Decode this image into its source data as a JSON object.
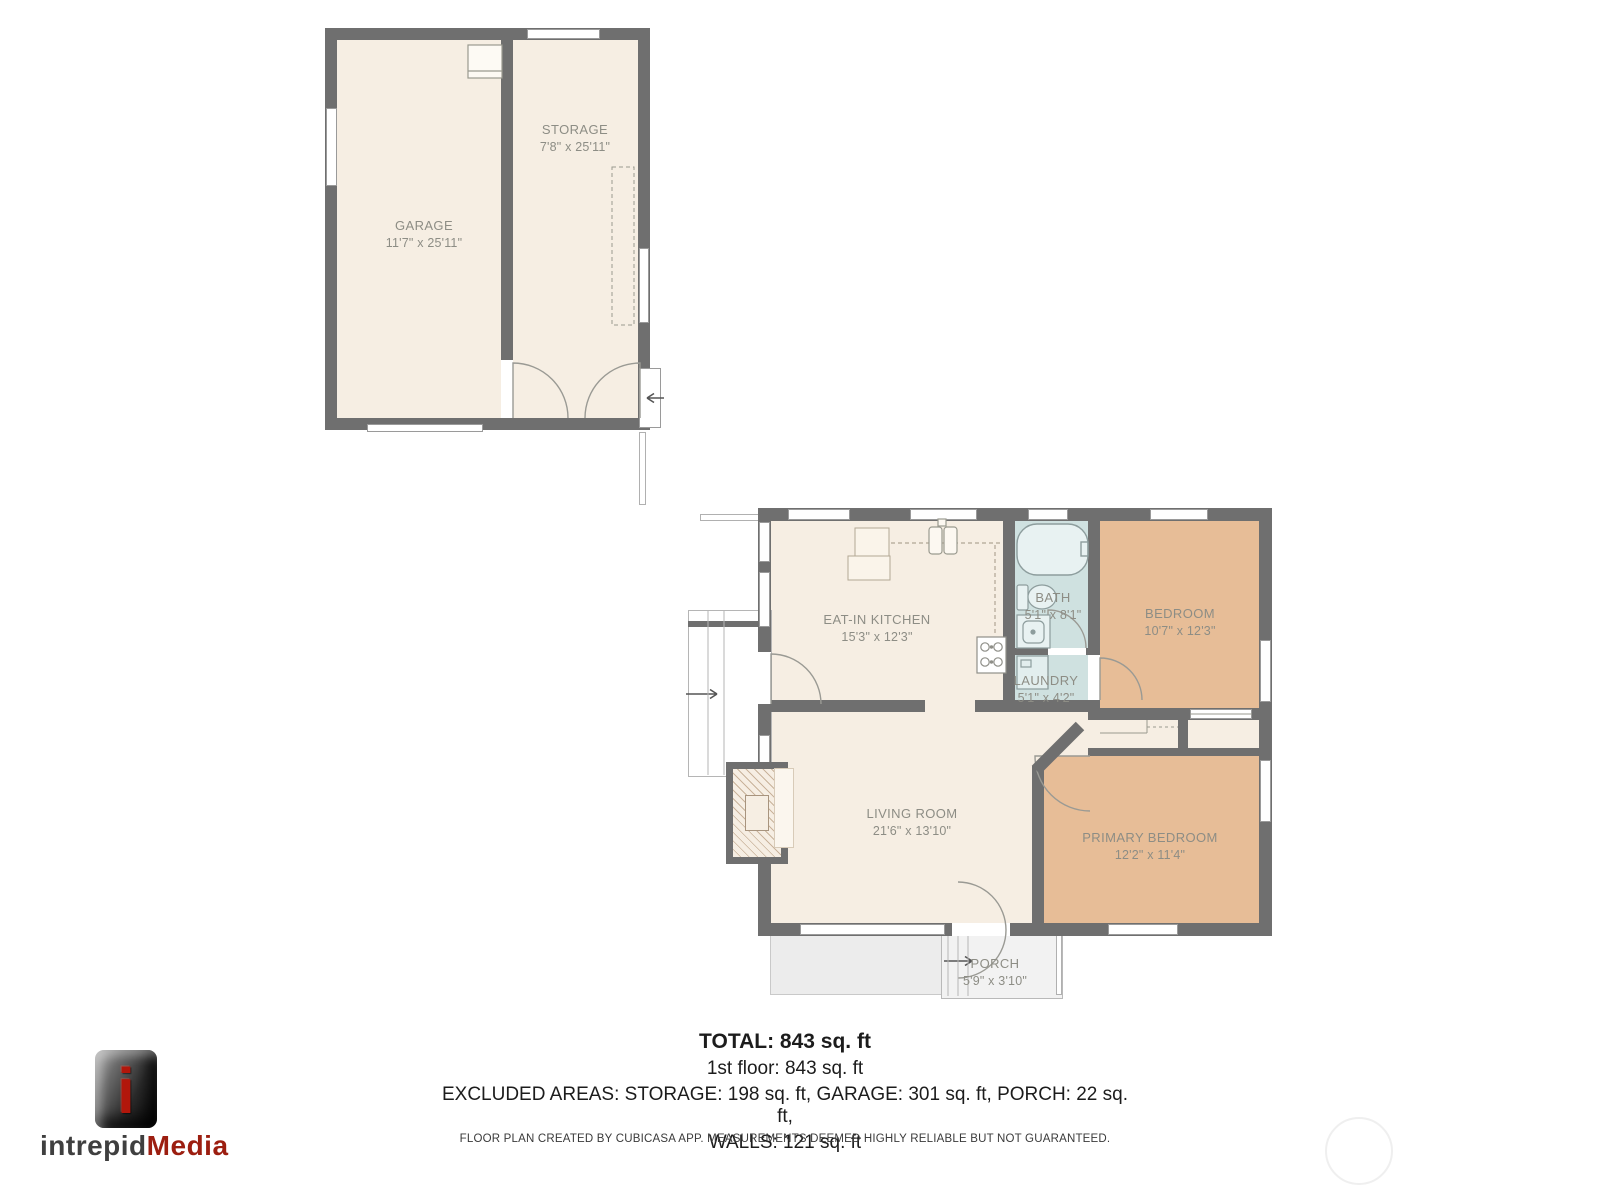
{
  "colors": {
    "wall": "#6f6f6f",
    "room_cream": "#f6eee3",
    "room_tan": "#e7bd97",
    "room_wet_blue": "#cfe1e0",
    "porch_gray": "#ececec",
    "room_label": "#8d8d85",
    "logo_red": "#9c1e10"
  },
  "garage_building": {
    "rooms": [
      {
        "name": "GARAGE",
        "dims": "11'7\" x 25'11\""
      },
      {
        "name": "STORAGE",
        "dims": "7'8\" x 25'11\""
      }
    ]
  },
  "house": {
    "rooms": [
      {
        "name": "EAT-IN KITCHEN",
        "dims": "15'3\" x 12'3\""
      },
      {
        "name": "BATH",
        "dims": "5'1\" x 8'1\""
      },
      {
        "name": "LAUNDRY",
        "dims": "5'1\" x 4'2\""
      },
      {
        "name": "BEDROOM",
        "dims": "10'7\" x 12'3\""
      },
      {
        "name": "LIVING ROOM",
        "dims": "21'6\" x 13'10\""
      },
      {
        "name": "PRIMARY BEDROOM",
        "dims": "12'2\" x 11'4\""
      },
      {
        "name": "PORCH",
        "dims": "5'9\" x 3'10\""
      }
    ]
  },
  "summary": {
    "total": "TOTAL: 843 sq. ft",
    "first_floor": "1st floor: 843 sq. ft",
    "excluded": "EXCLUDED AREAS: STORAGE: 198 sq. ft, GARAGE: 301 sq. ft, PORCH: 22 sq. ft,",
    "walls": "WALLS: 121 sq. ft"
  },
  "footer": {
    "disclaimer": "FLOOR PLAN CREATED BY CUBICASA APP. MEASUREMENTS DEEMED HIGHLY RELIABLE BUT NOT GUARANTEED."
  },
  "logo": {
    "icon_letter": "i",
    "brand_left": "intrepid",
    "brand_right": "Media"
  }
}
